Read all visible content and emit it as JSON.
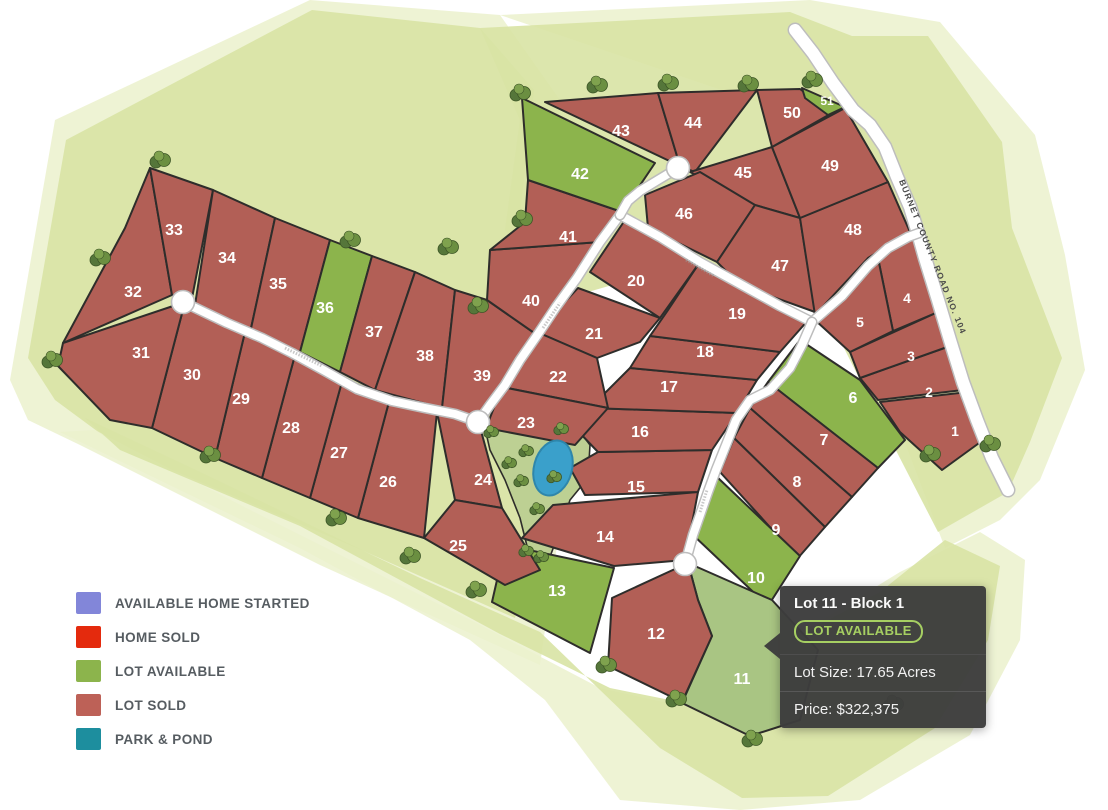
{
  "map": {
    "road_label": "BURNET COUNTY ROAD NO. 104",
    "colors": {
      "sold": "#b25f56",
      "available": "#8cb44c",
      "selected": "#a9c583",
      "park": "#bdd093",
      "pond": "#3aa0cb",
      "pond_stroke": "#2e86ab",
      "lot_stroke": "#2e2d2b",
      "road_fill": "#ffffff",
      "road_casing": "#bdbdbd",
      "buffer_mid": "#d8e3a4",
      "buffer_pale": "#ebf1cd",
      "tree_dark": "#55763a",
      "tree_mid": "#6b8f41",
      "tree_light": "#7fa24e",
      "lot_number_color": "#ffffff",
      "road_label_color": "#4a4a4a"
    },
    "buffers": [
      {
        "name": "buffer-left-pale",
        "color": "#ebf1cd",
        "opacity": 0.85,
        "pts": "10,380 55,120 310,0 500,15 560,100 540,300 572,440 540,665 320,565 80,445 28,420"
      },
      {
        "name": "buffer-left-mid",
        "color": "#d8e3a4",
        "opacity": 0.9,
        "pts": "28,358 66,140 312,10 480,28 534,90 516,250 548,425 515,618 350,545 120,448 55,400"
      },
      {
        "name": "buffer-ne-pale",
        "color": "#ebf1cd",
        "opacity": 0.85,
        "pts": "500,15 810,0 940,22 1035,135 1065,255 1085,370 1040,480 1000,520 945,548 900,430 860,280 810,120"
      },
      {
        "name": "buffer-ne-mid",
        "color": "#d8e3a4",
        "opacity": 0.9,
        "pts": "480,28 790,12 852,36 928,36 1002,142 1012,228 1062,358 1030,442 1008,492 938,532 870,400 820,300 700,260 560,300 505,230 520,120"
      },
      {
        "name": "buffer-bottom-pale",
        "color": "#ebf1cd",
        "opacity": 0.85,
        "pts": "60,432 300,548 470,640 545,700 620,800 740,810 860,800 970,735 1020,640 1025,560 980,532 900,572 790,640 700,710 600,688 480,625 250,510 95,430"
      },
      {
        "name": "buffer-bottom-mid",
        "color": "#d8e3a4",
        "opacity": 0.9,
        "pts": "85,418 200,472 420,578 540,632 660,748 742,798 828,796 935,728 988,640 1000,566 945,540 880,592 780,646 700,706 610,688 500,634 300,526 120,450"
      }
    ],
    "park": {
      "pts": "484,424 530,431 572,421 590,445 588,478 570,500 560,530 548,562 528,550 520,518 505,480 490,450",
      "pond": {
        "cx": 553,
        "cy": 468,
        "rx": 19,
        "ry": 28,
        "rot": 15
      }
    },
    "lots": [
      {
        "n": 1,
        "status": "sold",
        "lx": 955,
        "ly": 431,
        "fs": 14,
        "pts": "880,402 968,392 986,438 942,470 900,432"
      },
      {
        "n": 2,
        "status": "sold",
        "lx": 929,
        "ly": 392,
        "fs": 14,
        "pts": "860,378 950,346 963,390 878,400"
      },
      {
        "n": 3,
        "status": "sold",
        "lx": 911,
        "ly": 356,
        "fs": 14,
        "pts": "850,352 938,312 950,346 860,378"
      },
      {
        "n": 4,
        "status": "sold",
        "lx": 907,
        "ly": 298,
        "fs": 14,
        "pts": "878,258 914,238 938,312 893,331"
      },
      {
        "n": 5,
        "status": "sold",
        "lx": 860,
        "ly": 322,
        "fs": 14,
        "pts": "840,293 878,258 893,331 850,352 815,320"
      },
      {
        "n": 6,
        "status": "available",
        "lx": 853,
        "ly": 398,
        "pts": "800,340 860,380 905,440 878,468 768,382"
      },
      {
        "n": 7,
        "status": "sold",
        "lx": 824,
        "ly": 440,
        "pts": "768,382 878,468 852,497 750,408"
      },
      {
        "n": 8,
        "status": "sold",
        "lx": 797,
        "ly": 482,
        "pts": "750,408 852,497 825,527 734,438"
      },
      {
        "n": 9,
        "status": "sold",
        "lx": 776,
        "ly": 530,
        "pts": "734,438 825,527 798,558 720,472"
      },
      {
        "n": 10,
        "status": "available",
        "lx": 756,
        "ly": 578,
        "pts": "716,476 800,556 768,606 692,534"
      },
      {
        "n": 11,
        "status": "selected",
        "lx": 742,
        "ly": 679,
        "pts": "688,563 772,600 818,650 800,720 750,736 682,703 712,636 698,600"
      },
      {
        "n": 12,
        "status": "sold",
        "lx": 656,
        "ly": 634,
        "pts": "612,598 688,563 698,600 712,636 682,702 608,666"
      },
      {
        "n": 13,
        "status": "available",
        "lx": 557,
        "ly": 591,
        "pts": "505,545 614,568 590,653 492,602"
      },
      {
        "n": 14,
        "status": "sold",
        "lx": 605,
        "ly": 537,
        "pts": "553,505 698,492 685,560 614,566 522,538"
      },
      {
        "n": 15,
        "status": "sold",
        "lx": 636,
        "ly": 487,
        "pts": "598,452 712,450 698,492 585,495 570,468"
      },
      {
        "n": 16,
        "status": "sold",
        "lx": 640,
        "ly": 432,
        "pts": "590,408 737,413 712,450 598,452 575,428"
      },
      {
        "n": 17,
        "status": "sold",
        "lx": 669,
        "ly": 387,
        "pts": "630,368 757,380 737,413 590,408"
      },
      {
        "n": 18,
        "status": "sold",
        "lx": 705,
        "ly": 352,
        "pts": "650,336 780,352 757,380 630,368"
      },
      {
        "n": 19,
        "status": "sold",
        "lx": 737,
        "ly": 314,
        "pts": "700,262 810,318 780,352 650,336 668,310"
      },
      {
        "n": 20,
        "status": "sold",
        "lx": 636,
        "ly": 281,
        "pts": "625,220 700,262 660,318 590,272"
      },
      {
        "n": 21,
        "status": "sold",
        "lx": 594,
        "ly": 334,
        "pts": "578,288 660,318 640,342 597,358 537,332"
      },
      {
        "n": 22,
        "status": "sold",
        "lx": 558,
        "ly": 377,
        "pts": "537,332 597,358 608,408 502,387"
      },
      {
        "n": 23,
        "status": "sold",
        "lx": 526,
        "ly": 423,
        "pts": "502,387 608,408 575,445 486,428"
      },
      {
        "n": 24,
        "status": "sold",
        "lx": 483,
        "ly": 480,
        "pts": "437,412 480,427 502,508 455,500"
      },
      {
        "n": 25,
        "status": "sold",
        "lx": 458,
        "ly": 546,
        "pts": "424,538 455,500 502,508 540,570 505,585"
      },
      {
        "n": 26,
        "status": "sold",
        "lx": 388,
        "ly": 482,
        "pts": "390,398 437,412 424,538 358,518"
      },
      {
        "n": 27,
        "status": "sold",
        "lx": 339,
        "ly": 453,
        "pts": "343,378 390,398 358,518 310,498"
      },
      {
        "n": 28,
        "status": "sold",
        "lx": 291,
        "ly": 428,
        "pts": "295,355 343,378 310,498 262,478"
      },
      {
        "n": 29,
        "status": "sold",
        "lx": 241,
        "ly": 399,
        "pts": "245,332 295,355 262,478 215,458"
      },
      {
        "n": 30,
        "status": "sold",
        "lx": 192,
        "ly": 375,
        "pts": "185,302 245,332 215,458 152,428"
      },
      {
        "n": 31,
        "status": "sold",
        "lx": 141,
        "ly": 353,
        "pts": "58,366 63,343 185,302 152,428 110,420"
      },
      {
        "n": 32,
        "status": "sold",
        "lx": 133,
        "ly": 292,
        "pts": "63,343 125,228 150,168 172,295"
      },
      {
        "n": 33,
        "status": "sold",
        "lx": 174,
        "ly": 230,
        "pts": "150,168 213,190 192,298 172,295"
      },
      {
        "n": 34,
        "status": "sold",
        "lx": 227,
        "ly": 258,
        "pts": "213,190 275,218 250,333 195,305"
      },
      {
        "n": 35,
        "status": "sold",
        "lx": 278,
        "ly": 284,
        "pts": "275,218 330,240 300,352 250,333"
      },
      {
        "n": 36,
        "status": "available",
        "lx": 325,
        "ly": 308,
        "pts": "330,240 372,256 340,372 300,352"
      },
      {
        "n": 37,
        "status": "sold",
        "lx": 374,
        "ly": 332,
        "pts": "372,256 415,272 375,390 340,372"
      },
      {
        "n": 38,
        "status": "sold",
        "lx": 425,
        "ly": 356,
        "pts": "415,272 455,290 442,408 375,390"
      },
      {
        "n": 39,
        "status": "sold",
        "lx": 482,
        "ly": 376,
        "pts": "455,290 487,300 540,337 478,420 442,408"
      },
      {
        "n": 40,
        "status": "sold",
        "lx": 531,
        "ly": 301,
        "pts": "490,250 600,242 540,337 487,300"
      },
      {
        "n": 41,
        "status": "sold",
        "lx": 568,
        "ly": 237,
        "pts": "528,180 622,212 600,242 490,250 525,222"
      },
      {
        "n": 42,
        "status": "available",
        "lx": 580,
        "ly": 174,
        "pts": "522,98 655,163 622,212 528,180"
      },
      {
        "n": 43,
        "status": "sold",
        "lx": 621,
        "ly": 131,
        "pts": "545,102 658,93 680,166"
      },
      {
        "n": 44,
        "status": "sold",
        "lx": 693,
        "ly": 123,
        "pts": "658,93 757,90 695,172 680,166"
      },
      {
        "n": 45,
        "status": "sold",
        "lx": 743,
        "ly": 173,
        "pts": "690,172 772,147 800,218 755,205"
      },
      {
        "n": 46,
        "status": "sold",
        "lx": 684,
        "ly": 214,
        "pts": "645,195 700,172 755,205 717,262 648,228"
      },
      {
        "n": 47,
        "status": "sold",
        "lx": 780,
        "ly": 266,
        "pts": "755,205 800,218 815,312 740,285 717,262"
      },
      {
        "n": 48,
        "status": "sold",
        "lx": 853,
        "ly": 230,
        "pts": "800,218 888,182 910,232 868,258 815,315"
      },
      {
        "n": 49,
        "status": "sold",
        "lx": 830,
        "ly": 166,
        "pts": "772,147 845,108 888,182 800,218"
      },
      {
        "n": 50,
        "status": "sold",
        "lx": 792,
        "ly": 113,
        "pts": "757,90 800,89 832,113 772,147"
      },
      {
        "n": 51,
        "status": "available",
        "lx": 827,
        "ly": 100,
        "fs": 12,
        "pts": "802,88 845,107 828,115 805,98"
      }
    ],
    "roads": [
      {
        "name": "burnet-county-road",
        "w": 12,
        "pts": "795,30 813,53 833,83 853,110 870,125 885,147 897,177 910,207 918,233 925,258 938,300 950,340 963,382 977,420 992,458 1008,490"
      },
      {
        "name": "road-left-wing",
        "w": 8,
        "pts": "183,302 227,323 262,338 292,353 325,371 357,389 392,401 425,408 455,414 478,422"
      },
      {
        "name": "road-southwest",
        "w": 8,
        "pts": "620,215 600,242 577,278 556,307 538,334 520,360 505,385 490,405 478,422"
      },
      {
        "name": "road-northeast-diagonal",
        "w": 8,
        "pts": "620,215 660,237 700,262 740,284 780,306 812,322"
      },
      {
        "name": "road-culdesac-spur",
        "w": 8,
        "pts": "678,168 658,180 640,191 628,201 620,215"
      },
      {
        "name": "road-entrance",
        "w": 8,
        "pts": "812,322 842,296 868,266 888,248 908,237 919,233"
      },
      {
        "name": "road-south-winding",
        "w": 8,
        "pts": "812,322 802,345 790,368 770,390 750,400 736,420 726,445 716,470 708,492 700,515 693,535 685,564"
      }
    ],
    "culdesacs": [
      [
        183,
        302
      ],
      [
        678,
        168
      ],
      [
        478,
        422
      ],
      [
        685,
        564
      ]
    ],
    "street_marks": [
      [
        285,
        348,
        322,
        366
      ],
      [
        543,
        328,
        560,
        303
      ],
      [
        686,
        260,
        714,
        276
      ],
      [
        700,
        512,
        707,
        490
      ]
    ],
    "trees": {
      "clusters": [
        [
          160,
          160
        ],
        [
          350,
          240
        ],
        [
          448,
          247
        ],
        [
          478,
          306
        ],
        [
          522,
          219
        ],
        [
          520,
          93
        ],
        [
          597,
          85
        ],
        [
          668,
          83
        ],
        [
          748,
          84
        ],
        [
          812,
          80
        ],
        [
          100,
          258
        ],
        [
          52,
          360
        ],
        [
          210,
          455
        ],
        [
          336,
          518
        ],
        [
          410,
          556
        ],
        [
          476,
          590
        ],
        [
          606,
          665
        ],
        [
          676,
          699
        ],
        [
          752,
          739
        ],
        [
          893,
          704
        ],
        [
          930,
          454
        ],
        [
          990,
          444
        ]
      ],
      "park": [
        [
          491,
          432
        ],
        [
          561,
          429
        ],
        [
          526,
          451
        ],
        [
          509,
          463
        ],
        [
          521,
          481
        ],
        [
          554,
          477
        ],
        [
          537,
          509
        ],
        [
          526,
          551
        ],
        [
          541,
          557
        ]
      ]
    }
  },
  "legend": {
    "items": [
      {
        "key": "available-home-started",
        "label": "AVAILABLE HOME STARTED",
        "color": "#8286d9"
      },
      {
        "key": "home-sold",
        "label": "HOME SOLD",
        "color": "#e42a0d"
      },
      {
        "key": "lot-available",
        "label": "LOT AVAILABLE",
        "color": "#8cb44c"
      },
      {
        "key": "lot-sold",
        "label": "LOT SOLD",
        "color": "#bd6157"
      },
      {
        "key": "park-pond",
        "label": "PARK & POND",
        "color": "#1d8e9e"
      }
    ]
  },
  "tooltip": {
    "title": "Lot 11 - Block 1",
    "status_badge": "LOT AVAILABLE",
    "lot_size": "Lot Size: 17.65 Acres",
    "price": "Price: $322,375"
  }
}
